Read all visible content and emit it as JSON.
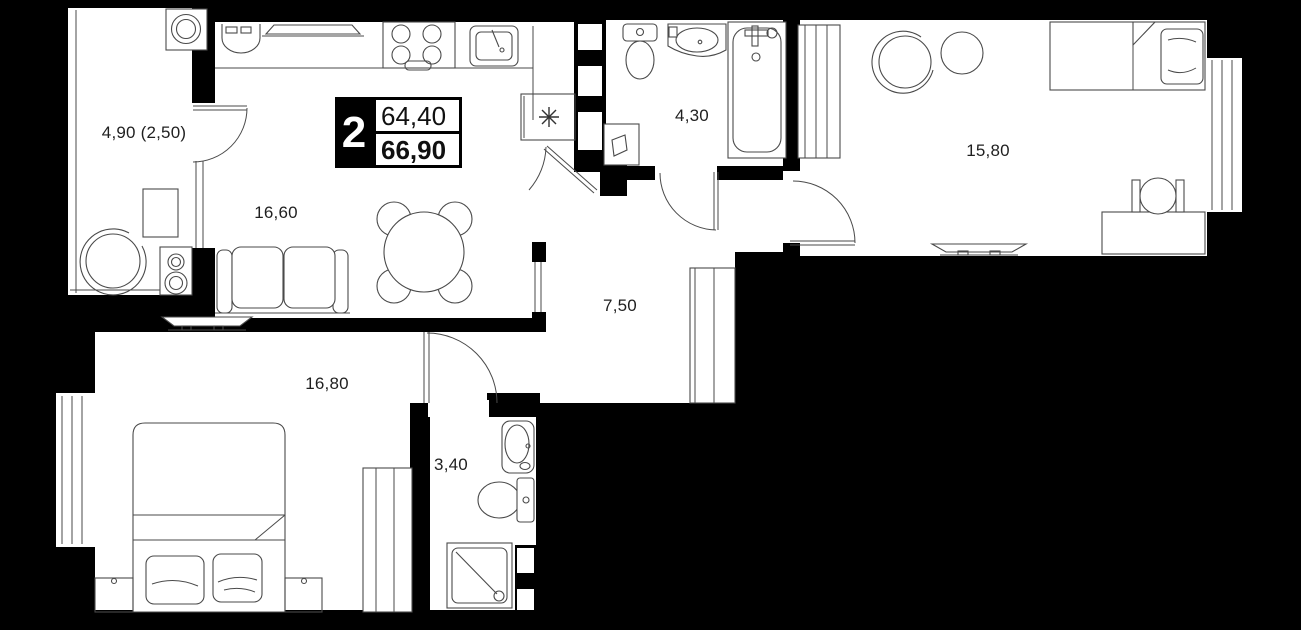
{
  "plan": {
    "badge": {
      "rooms": "2",
      "area_top": "64,40",
      "area_bottom": "66,90"
    },
    "rooms": [
      {
        "id": "balcony",
        "area": "4,90 (2,50)"
      },
      {
        "id": "kitchen-living",
        "area": "16,60"
      },
      {
        "id": "bathroom",
        "area": "4,30"
      },
      {
        "id": "bedroom-right",
        "area": "15,80"
      },
      {
        "id": "hallway",
        "area": "7,50"
      },
      {
        "id": "bedroom-left",
        "area": "16,80"
      },
      {
        "id": "wc",
        "area": "3,40"
      }
    ],
    "symbols": {
      "appliance_mark": "✳"
    }
  }
}
